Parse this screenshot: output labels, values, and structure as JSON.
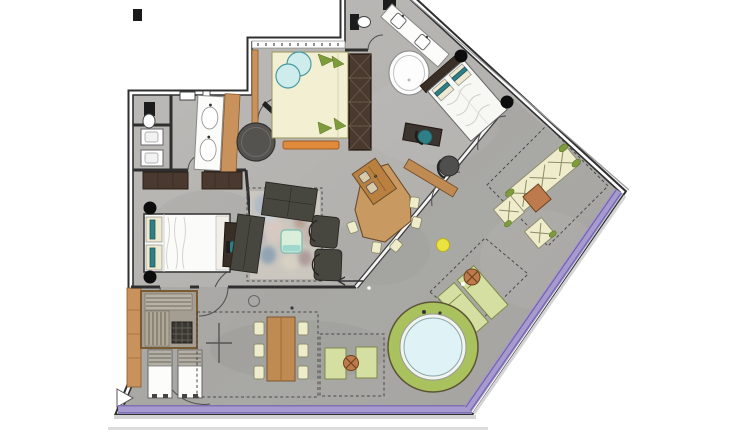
{
  "title": "apartment-floor-plan",
  "colors": {
    "floor_interior": "#b3b1ae",
    "floor_terrace": "#a8a7a4",
    "wall_dark": "#2f2f2f",
    "wall_white": "#ffffff",
    "glass_purple": "#a79ace",
    "purple_dark": "#7263ab",
    "wood_light": "#c9925c",
    "wood_mid": "#c08b52",
    "wood_dark": "#4a392e",
    "cream": "#f2efd2",
    "cream_furniture": "#efeccb",
    "teal": "#2e7f86",
    "teal_light": "#cdeceb",
    "mint": "#d9efdc",
    "mint_stripe": "#9fd8cf",
    "dark_furniture": "#47463f",
    "green_ring": "#a9c25d",
    "water": "#dff3f6",
    "pale_green": "#d6dfa2",
    "terracotta": "#bd7a4d",
    "yellow": "#ece23f",
    "leaf_green": "#7f9c3c",
    "rug_base": "#cbc7bf",
    "outline": "#333333"
  },
  "elements": [
    {
      "name": "master-bed-icon"
    },
    {
      "name": "guest-bed-icon"
    },
    {
      "name": "diagonal-bed-icon"
    },
    {
      "name": "freestanding-bathtub-icon"
    },
    {
      "name": "round-shower-icon"
    },
    {
      "name": "double-vanity-icon"
    },
    {
      "name": "toilet-icon"
    },
    {
      "name": "wardrobe-icon"
    },
    {
      "name": "sofa-icon"
    },
    {
      "name": "coffee-table-icon"
    },
    {
      "name": "area-rug-icon"
    },
    {
      "name": "kitchen-island-icon"
    },
    {
      "name": "desk-icon"
    },
    {
      "name": "sauna-icon"
    },
    {
      "name": "sun-lounger-icon"
    },
    {
      "name": "outdoor-dining-table-icon"
    },
    {
      "name": "outdoor-lounge-set-icon"
    },
    {
      "name": "parasol-icon"
    },
    {
      "name": "hot-tub-icon"
    },
    {
      "name": "entrance-arrow-icon"
    }
  ]
}
